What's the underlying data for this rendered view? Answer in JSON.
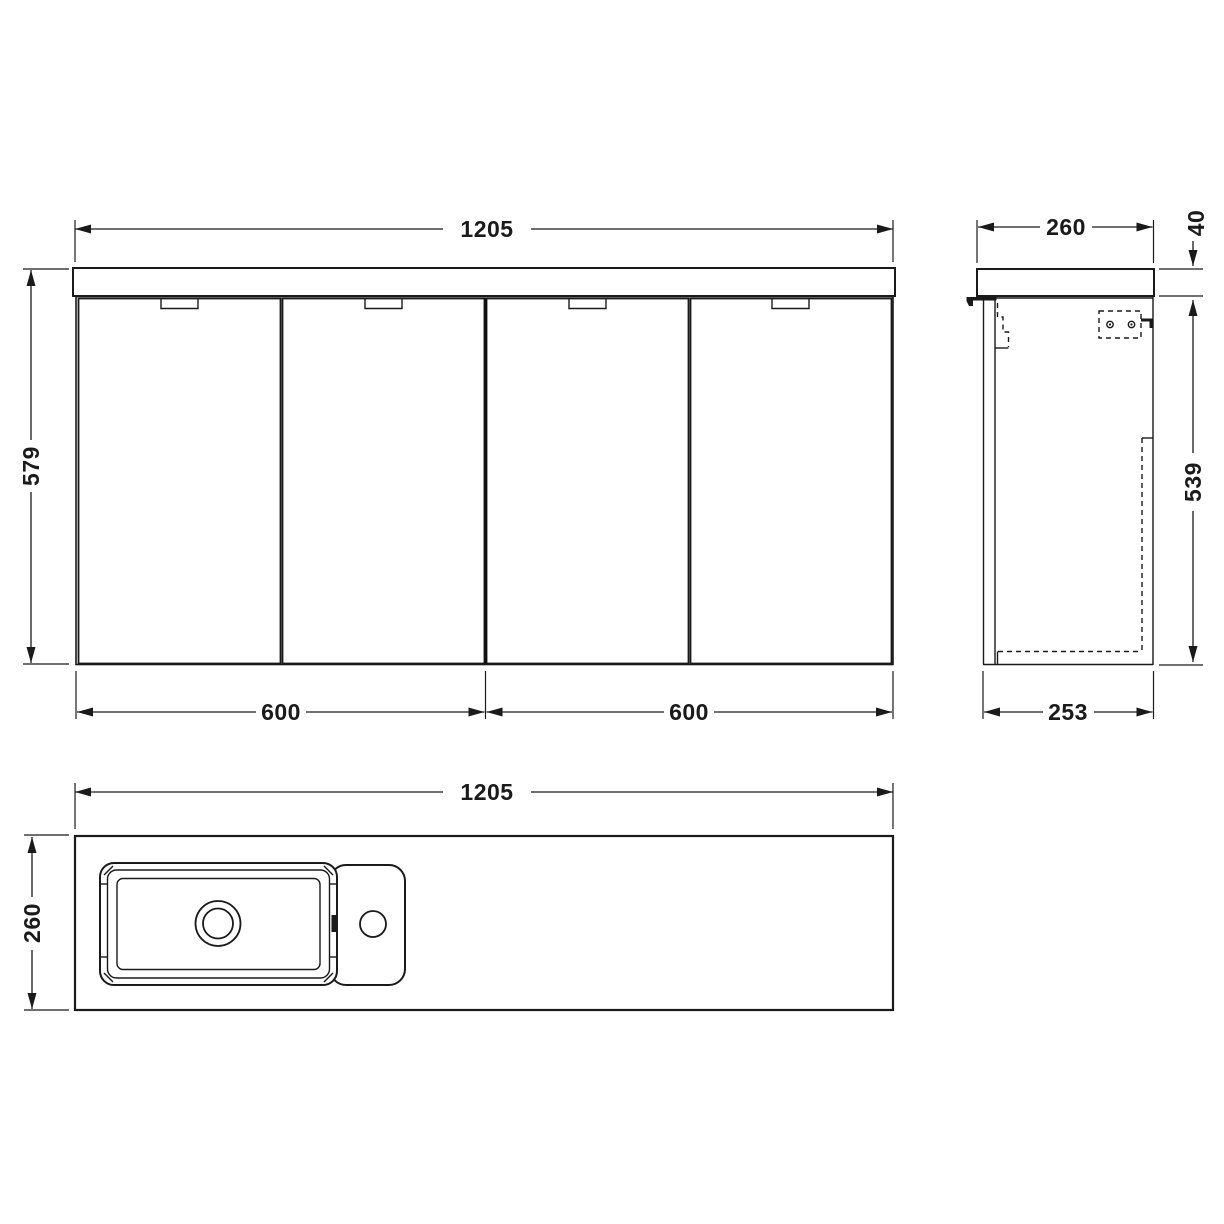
{
  "title": "Wall hung vanity unit with basin - dimensioned technical drawing",
  "dims": {
    "front_width": "1205",
    "front_height": "579",
    "front_left_section": "600",
    "front_right_section": "600",
    "side_depth": "260",
    "side_worktop_height": "40",
    "side_cabinet_height": "539",
    "side_cabinet_depth": "253",
    "plan_width": "1205",
    "plan_depth": "260"
  }
}
